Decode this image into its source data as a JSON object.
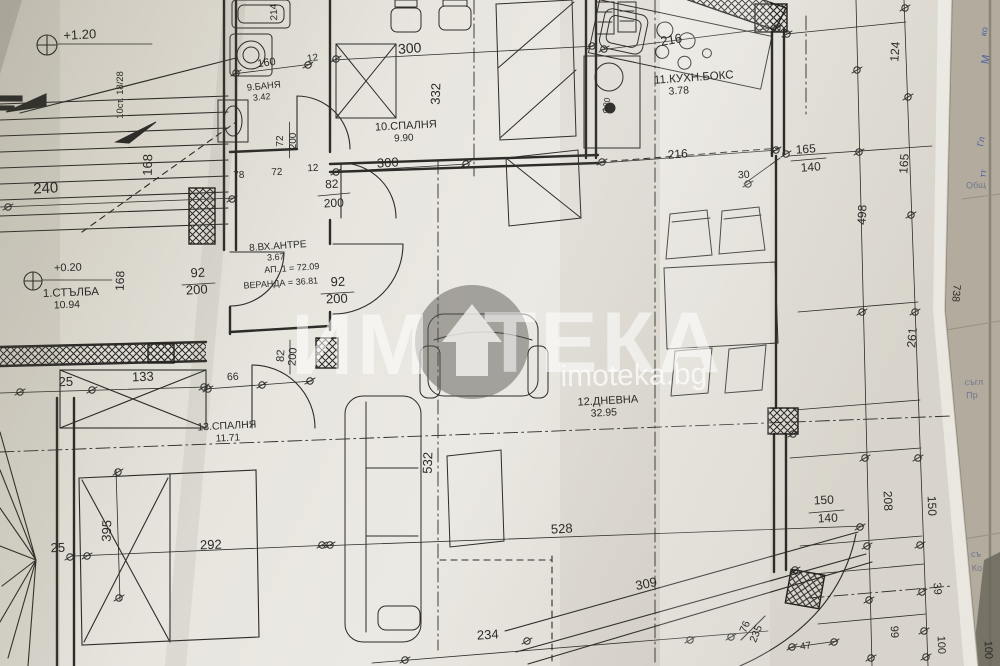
{
  "watermark": {
    "brand_left": "ИМ",
    "brand_right": "ТЕКА",
    "url": "imoteka.bg"
  },
  "rooms": [
    {
      "label": "1.СТЪЛБА",
      "area": "10.94"
    },
    {
      "label": "8.ВХ.АНТРЕ",
      "area": "3.67"
    },
    {
      "label": "9.БАНЯ",
      "area": "3.42"
    },
    {
      "label": "10.СПАЛНЯ",
      "area": "9.90"
    },
    {
      "label": "11.КУХН.БОКС",
      "area": "3.78"
    },
    {
      "label": "12.ДНЕВНА",
      "area": "32.95"
    },
    {
      "label": "13.СПАЛНЯ",
      "area": "11.71"
    }
  ],
  "annotations": {
    "apartment_total": "АП. 1 = 72.09",
    "veranda_total": "ВЕРАНДА = 36.81",
    "levels": [
      "+1.20",
      "+0.20"
    ],
    "stairs_note": "10ст. 18/28",
    "door_window_specs": [
      "72/200",
      "82/200",
      "92/200",
      "92/200",
      "82/200",
      "165/140",
      "150/140",
      "76/235"
    ],
    "dimensions": [
      "240",
      "160",
      "12",
      "214",
      "168",
      "78",
      "72",
      "12",
      "300",
      "332",
      "300",
      "216",
      "216",
      "30",
      "124",
      "165",
      "498",
      "261",
      "738",
      "66",
      "25",
      "133",
      "395",
      "25",
      "292",
      "532",
      "528",
      "234",
      "309",
      "208",
      "150",
      "39",
      "99",
      "100",
      "100",
      "47",
      "Ф20",
      "168"
    ]
  },
  "labels": [
    {
      "n": "level-mark-upper",
      "t": "+1.20",
      "x": 80,
      "y": 39,
      "r": -3,
      "s": 13
    },
    {
      "n": "stairs-note",
      "t": "10ст. 18/28",
      "x": 123,
      "y": 95,
      "r": -90,
      "s": 9.5
    },
    {
      "n": "dim-168-stairs",
      "t": "168",
      "x": 152,
      "y": 165,
      "r": -89,
      "s": 13
    },
    {
      "n": "dim-240",
      "t": "240",
      "x": 46,
      "y": 193,
      "r": -3,
      "s": 15
    },
    {
      "n": "dim-160",
      "t": "160",
      "x": 267,
      "y": 66,
      "r": -8,
      "s": 11
    },
    {
      "n": "dim-12-top",
      "t": "12",
      "x": 313,
      "y": 61,
      "r": -8,
      "s": 10
    },
    {
      "n": "dim-214",
      "t": "214",
      "x": 277,
      "y": 12,
      "r": -92,
      "s": 10
    },
    {
      "n": "room-bath-name",
      "t": "9.БАНЯ",
      "x": 264,
      "y": 89,
      "r": -6,
      "s": 9.5
    },
    {
      "n": "room-bath-area",
      "t": "3.42",
      "x": 262,
      "y": 100,
      "r": -6,
      "s": 9
    },
    {
      "n": "door-72-width",
      "t": "72",
      "x": 283,
      "y": 141,
      "r": -90,
      "s": 10
    },
    {
      "n": "door-72-height",
      "t": "200",
      "x": 296,
      "y": 141,
      "r": -90,
      "s": 10
    },
    {
      "n": "dim-78",
      "t": "78",
      "x": 239,
      "y": 178,
      "r": -3,
      "s": 10
    },
    {
      "n": "dim-72",
      "t": "72",
      "x": 277,
      "y": 175,
      "r": -3,
      "s": 10
    },
    {
      "n": "dim-12-mid",
      "t": "12",
      "x": 313,
      "y": 171,
      "r": -3,
      "s": 10
    },
    {
      "n": "door-82a-width",
      "t": "82",
      "x": 332,
      "y": 188,
      "r": -3,
      "s": 12
    },
    {
      "n": "door-82a-height",
      "t": "200",
      "x": 334,
      "y": 207,
      "r": -3,
      "s": 12
    },
    {
      "n": "dim-300-top",
      "t": "300",
      "x": 410,
      "y": 53,
      "r": -4,
      "s": 14
    },
    {
      "n": "dim-332",
      "t": "332",
      "x": 440,
      "y": 94,
      "r": -88,
      "s": 13
    },
    {
      "n": "room-bedroom10-name",
      "t": "10.СПАЛНЯ",
      "x": 406,
      "y": 129,
      "r": -3,
      "s": 11
    },
    {
      "n": "room-bedroom10-area",
      "t": "9.90",
      "x": 404,
      "y": 141,
      "r": -3,
      "s": 10
    },
    {
      "n": "dim-300-bottom",
      "t": "300",
      "x": 388,
      "y": 167,
      "r": -3,
      "s": 13
    },
    {
      "n": "dim-216-kitchen-top",
      "t": "216",
      "x": 672,
      "y": 44,
      "r": -10,
      "s": 13
    },
    {
      "n": "room-kitchen-name",
      "t": "11.КУХН.БОКС",
      "x": 694,
      "y": 81,
      "r": -4,
      "s": 11.5
    },
    {
      "n": "room-kitchen-area",
      "t": "3.78",
      "x": 679,
      "y": 94,
      "r": -4,
      "s": 10.5
    },
    {
      "n": "column-f20",
      "t": "Ф20",
      "x": 609,
      "y": 106,
      "r": -80,
      "s": 8.5
    },
    {
      "n": "dim-216-kitchen-bottom",
      "t": "216",
      "x": 678,
      "y": 158,
      "r": -4,
      "s": 12
    },
    {
      "n": "window-165",
      "t": "165",
      "x": 806,
      "y": 153,
      "r": -4,
      "s": 12
    },
    {
      "n": "window-140",
      "t": "140",
      "x": 811,
      "y": 171,
      "r": -4,
      "s": 12
    },
    {
      "n": "dim-30",
      "t": "30",
      "x": 744,
      "y": 178,
      "r": -4,
      "s": 10.5
    },
    {
      "n": "dim-124",
      "t": "124",
      "x": 899,
      "y": 52,
      "r": -86,
      "s": 12
    },
    {
      "n": "dim-165-chain",
      "t": "165",
      "x": 908,
      "y": 164,
      "r": -86,
      "s": 12
    },
    {
      "n": "dim-498",
      "t": "498",
      "x": 866,
      "y": 215,
      "r": -87,
      "s": 12
    },
    {
      "n": "dim-261",
      "t": "261",
      "x": 916,
      "y": 338,
      "r": -85,
      "s": 12
    },
    {
      "n": "dim-738",
      "t": "738",
      "x": 953,
      "y": 293,
      "r": 95,
      "s": 10.5
    },
    {
      "n": "door-92a-width",
      "t": "92",
      "x": 198,
      "y": 277,
      "r": -3,
      "s": 13
    },
    {
      "n": "door-92a-height",
      "t": "200",
      "x": 197,
      "y": 294,
      "r": -3,
      "s": 13
    },
    {
      "n": "room-entry-name",
      "t": "8.ВХ.АНТРЕ",
      "x": 278,
      "y": 249,
      "r": -4,
      "s": 10
    },
    {
      "n": "room-entry-area",
      "t": "3.67",
      "x": 276,
      "y": 260,
      "r": -4,
      "s": 9
    },
    {
      "n": "apartment-total",
      "t": "АП. 1 = 72.09",
      "x": 292,
      "y": 271,
      "r": -4,
      "s": 9
    },
    {
      "n": "veranda-total",
      "t": "ВЕРАНДА = 36.81",
      "x": 281,
      "y": 286,
      "r": -4,
      "s": 9
    },
    {
      "n": "level-mark-lower",
      "t": "+0.20",
      "x": 68,
      "y": 271,
      "r": -2,
      "s": 11
    },
    {
      "n": "room-stairs-name",
      "t": "1.СТЪЛБА",
      "x": 71,
      "y": 296,
      "r": -2,
      "s": 11.5
    },
    {
      "n": "room-stairs-area",
      "t": "10.94",
      "x": 67,
      "y": 308,
      "r": -2,
      "s": 10.5
    },
    {
      "n": "door-92b-width",
      "t": "92",
      "x": 338,
      "y": 286,
      "r": -2,
      "s": 13
    },
    {
      "n": "door-92b-height",
      "t": "200",
      "x": 337,
      "y": 303,
      "r": -2,
      "s": 13
    },
    {
      "n": "dim-168-left",
      "t": "168",
      "x": 124,
      "y": 281,
      "r": -88,
      "s": 12
    },
    {
      "n": "door-82b-width",
      "t": "82",
      "x": 284,
      "y": 356,
      "r": -86,
      "s": 11
    },
    {
      "n": "door-82b-height",
      "t": "200",
      "x": 296,
      "y": 357,
      "r": -86,
      "s": 11
    },
    {
      "n": "dim-66",
      "t": "66",
      "x": 233,
      "y": 380,
      "r": -3,
      "s": 10.5
    },
    {
      "n": "dim-25-band",
      "t": "25",
      "x": 66,
      "y": 386,
      "r": -2,
      "s": 13
    },
    {
      "n": "dim-133",
      "t": "133",
      "x": 143,
      "y": 381,
      "r": -2,
      "s": 13
    },
    {
      "n": "room-bedroom13-name",
      "t": "13.СПАЛНЯ",
      "x": 227,
      "y": 429,
      "r": -3,
      "s": 10.5
    },
    {
      "n": "room-bedroom13-area",
      "t": "11.71",
      "x": 228,
      "y": 441,
      "r": -3,
      "s": 10
    },
    {
      "n": "dim-395",
      "t": "395",
      "x": 111,
      "y": 531,
      "r": -88,
      "s": 13
    },
    {
      "n": "dim-25-bed",
      "t": "25",
      "x": 58,
      "y": 552,
      "r": -2,
      "s": 13
    },
    {
      "n": "dim-292",
      "t": "292",
      "x": 211,
      "y": 549,
      "r": -2,
      "s": 13
    },
    {
      "n": "dim-532",
      "t": "532",
      "x": 432,
      "y": 463,
      "r": -88,
      "s": 13
    },
    {
      "n": "room-living-name",
      "t": "12.ДНЕВНА",
      "x": 608,
      "y": 404,
      "r": -3,
      "s": 11
    },
    {
      "n": "room-living-area",
      "t": "32.95",
      "x": 604,
      "y": 416,
      "r": -3,
      "s": 10.5
    },
    {
      "n": "dim-528",
      "t": "528",
      "x": 562,
      "y": 533,
      "r": -3,
      "s": 13
    },
    {
      "n": "dim-234",
      "t": "234",
      "x": 488,
      "y": 639,
      "r": -3,
      "s": 13
    },
    {
      "n": "dim-309",
      "t": "309",
      "x": 647,
      "y": 588,
      "r": -11,
      "s": 13
    },
    {
      "n": "window-150",
      "t": "150",
      "x": 824,
      "y": 504,
      "r": -3,
      "s": 12
    },
    {
      "n": "window-140b",
      "t": "140",
      "x": 828,
      "y": 522,
      "r": -3,
      "s": 12
    },
    {
      "n": "dim-208",
      "t": "208",
      "x": 884,
      "y": 501,
      "r": 88,
      "s": 12
    },
    {
      "n": "dim-150-chain",
      "t": "150",
      "x": 928,
      "y": 506,
      "r": 88,
      "s": 12
    },
    {
      "n": "dim-39",
      "t": "39",
      "x": 934,
      "y": 589,
      "r": 85,
      "s": 11
    },
    {
      "n": "dim-99",
      "t": "99",
      "x": 891,
      "y": 632,
      "r": 88,
      "s": 11
    },
    {
      "n": "dim-100a",
      "t": "100",
      "x": 938,
      "y": 645,
      "r": 88,
      "s": 11
    },
    {
      "n": "dim-100b",
      "t": "100",
      "x": 985,
      "y": 650,
      "r": 88,
      "s": 11
    },
    {
      "n": "door-76-width",
      "t": "76",
      "x": 748,
      "y": 628,
      "r": -68,
      "s": 10.5
    },
    {
      "n": "door-76-height",
      "t": "235",
      "x": 759,
      "y": 635,
      "r": -68,
      "s": 10.5
    },
    {
      "n": "dim-47",
      "t": "47",
      "x": 806,
      "y": 649,
      "r": -8,
      "s": 10
    },
    {
      "n": "watermark-brand-left",
      "t": "ИМ",
      "x": 362,
      "y": 374,
      "r": 0,
      "s": 86,
      "c": "rgba(255,255,255,0.55)",
      "w": true,
      "ls": 4
    },
    {
      "n": "watermark-brand-right",
      "t": "ТЕКА",
      "x": 604,
      "y": 372,
      "r": 0,
      "s": 86,
      "c": "rgba(255,255,255,0.55)",
      "w": true,
      "ls": 4
    },
    {
      "n": "watermark-url",
      "t": "imoteka.bg",
      "x": 634,
      "y": 385,
      "r": -1,
      "s": 30,
      "c": "rgba(255,255,255,0.72)",
      "w": false
    },
    {
      "n": "side-sheet-text-1",
      "t": "Общ",
      "x": 976,
      "y": 188,
      "r": -4,
      "s": 9,
      "c": "#6e7688"
    },
    {
      "n": "side-sheet-text-2",
      "t": "съгл",
      "x": 974,
      "y": 385,
      "r": -2,
      "s": 9,
      "c": "#6e7688"
    },
    {
      "n": "side-sheet-text-3",
      "t": "Пр",
      "x": 972,
      "y": 398,
      "r": -2,
      "s": 9,
      "c": "#6e7688"
    },
    {
      "n": "side-sheet-text-4",
      "t": "съ",
      "x": 976,
      "y": 557,
      "r": -2,
      "s": 9,
      "c": "#6e7688"
    },
    {
      "n": "side-sheet-text-5",
      "t": "Ко",
      "x": 977,
      "y": 571,
      "r": -2,
      "s": 9,
      "c": "#6e7688"
    },
    {
      "n": "handwriting-1",
      "t": "ко",
      "x": 987,
      "y": 32,
      "r": -80,
      "s": 9,
      "c": "#4a5f9e"
    },
    {
      "n": "handwriting-2",
      "t": "М",
      "x": 989,
      "y": 60,
      "r": -80,
      "s": 11,
      "c": "#4a5f9e"
    },
    {
      "n": "handwriting-3",
      "t": "Гл",
      "x": 984,
      "y": 142,
      "r": -80,
      "s": 9,
      "c": "#4a5f9e"
    },
    {
      "n": "handwriting-4",
      "t": "тт",
      "x": 986,
      "y": 174,
      "r": -80,
      "s": 9,
      "c": "#4a5f9e"
    }
  ]
}
